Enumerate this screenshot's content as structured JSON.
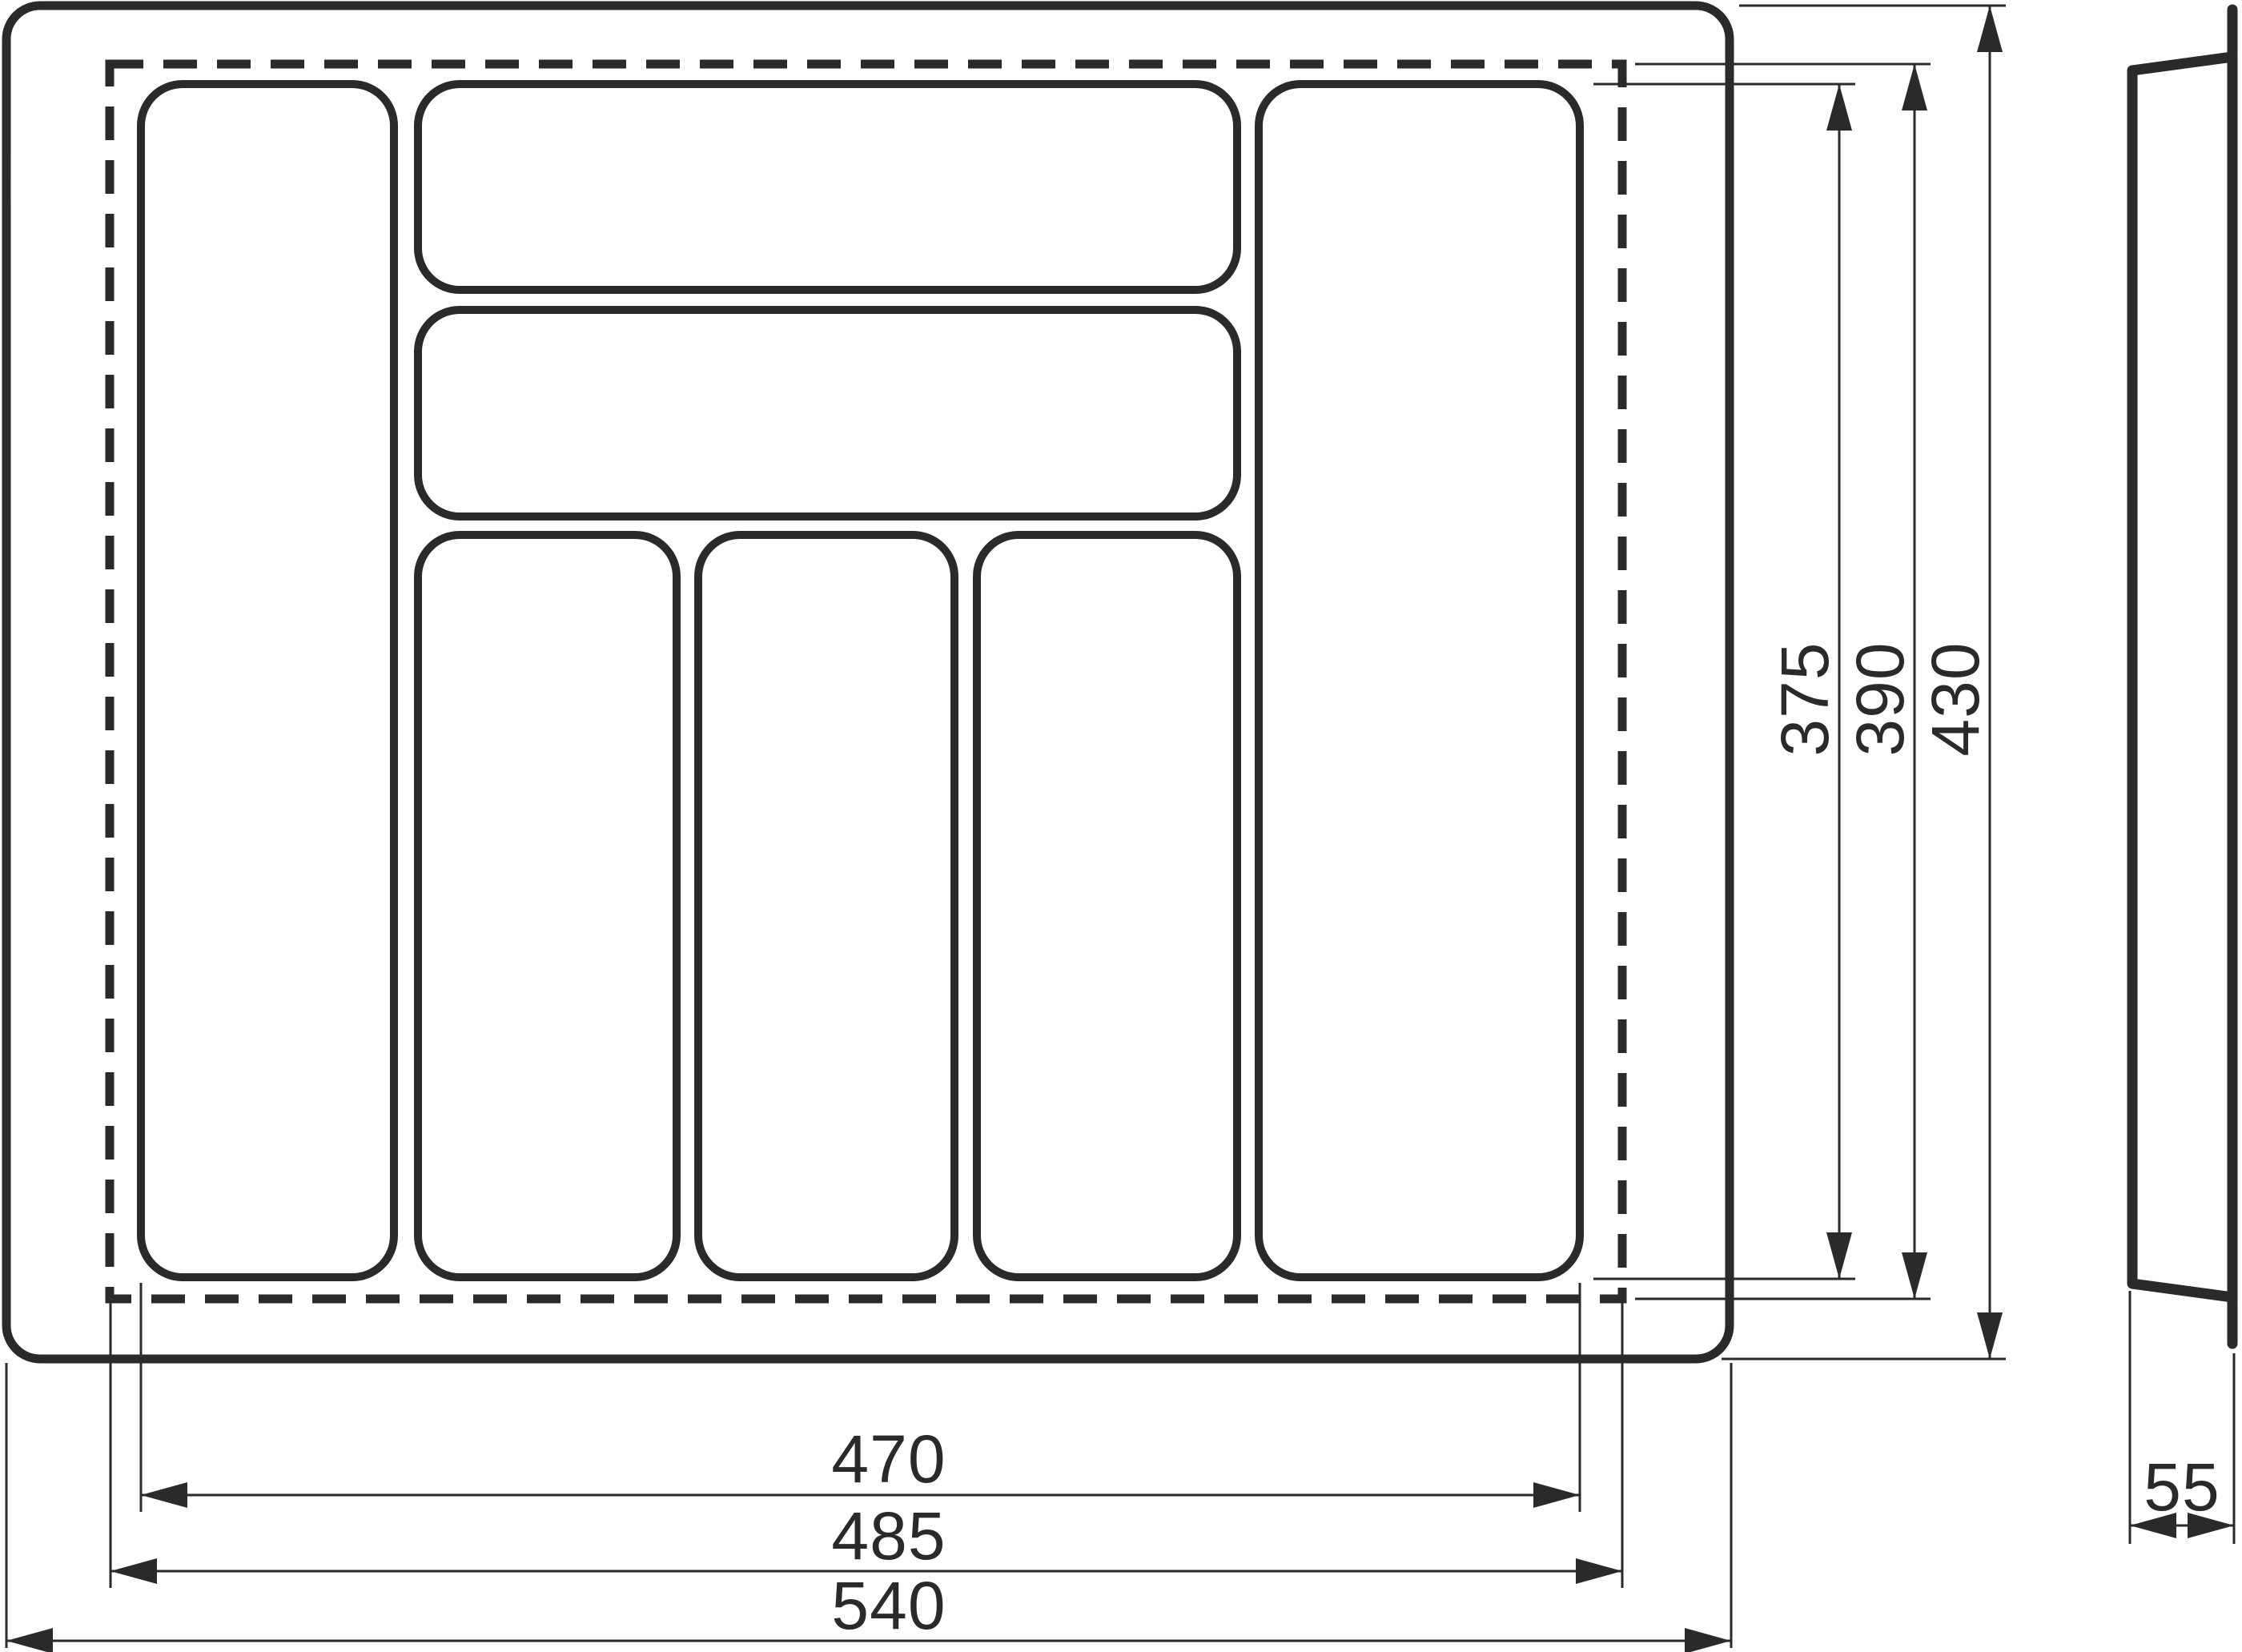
{
  "drawing": {
    "description": "Technical dimension drawing of a cutlery tray drawer insert: plan view with seven compartments and trim line, plus side profile view",
    "units": "mm",
    "colors": {
      "line": "#2b2a29",
      "background": "#ffffff"
    },
    "plan_view": {
      "width_dimensions": {
        "compartment_area": "470",
        "trim_size": "485",
        "overall": "540"
      },
      "height_dimensions": {
        "compartment_area": "375",
        "trim_size": "390",
        "overall": "430"
      },
      "compartment_count": 7
    },
    "side_view": {
      "depth_dimension": "55"
    }
  }
}
